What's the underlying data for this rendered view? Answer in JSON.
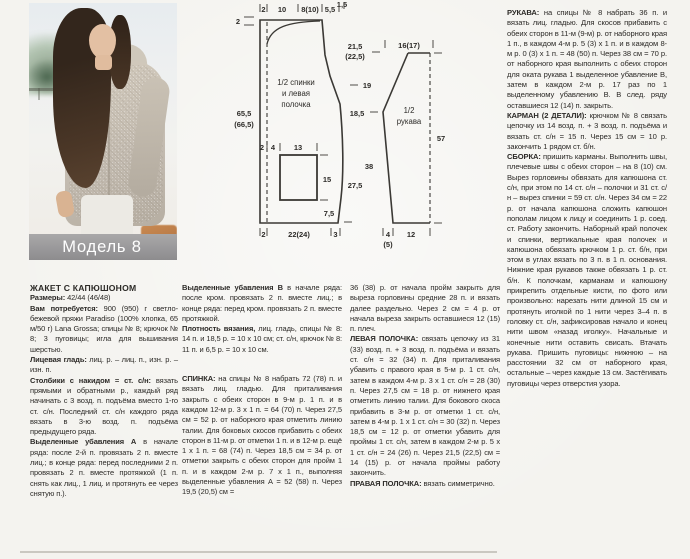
{
  "page": {
    "caption": "Модель 8"
  },
  "diagram": {
    "back": {
      "name_lines": [
        "1/2 спинки",
        "и левая",
        "полочка"
      ],
      "top_widths": [
        "2",
        "10",
        "8(10)",
        "5,5"
      ],
      "top_width_small": "1,5",
      "left_edge_top": "2",
      "height_total_1": "65,5",
      "height_total_2": "(66,5)",
      "pocket_left_1": "2",
      "pocket_left_2": "4",
      "pocket_width": "13",
      "pocket_height": "15",
      "pocket_to_hem": "7,5",
      "bottom_1": "2",
      "bottom_2": "22(24)",
      "bottom_3": "3"
    },
    "heights": {
      "h1a": "21,5",
      "h1b": "(22,5)",
      "h2": "19",
      "h3": "18,5",
      "h4": "27,5"
    },
    "sleeve": {
      "name_lines": [
        "1/2",
        "рукава"
      ],
      "top_width": "16(17)",
      "height": "57",
      "slant": "38",
      "bottom_1": "4",
      "bottom_1_alt": "(5)",
      "bottom_2": "12"
    }
  },
  "columns": {
    "col1": {
      "title": "ЖАКЕТ С КАПЮШОНОМ",
      "paras": [
        {
          "label": "Размеры:",
          "text": " 42/44 (46/48)"
        },
        {
          "label": "Вам потребуется:",
          "text": " 900 (950) г светло-бежевой пряжи Paradiso (100% хлопка, 65 м/50 г) Lana Grossa; спицы № 8; крючок № 8; 3 пуговицы; игла для вышивания шерстью."
        },
        {
          "label": "Лицевая гладь:",
          "text": " лиц. р. – лиц. п., изн. р. – изн. п."
        },
        {
          "label": "Столбики с накидом = ст. с/н:",
          "text": " вязать прямыми и обратными р., каждый ряд начинать с 3 возд. п. подъёма вместо 1-го ст. с/н. Последний ст. с/н каждого ряда вязать в 3-ю возд. п. подъёма предыдущего ряда."
        },
        {
          "label": "Выделенные убавления А",
          "text": " в начале ряда: после 2-й п. провязать 2 п. вместе лиц.; в конце ряда: перед последними 2 п. провязать 2 п. вместе протяжкой (1 п. снять как лиц., 1 лиц. и протянуть ее через снятую п.)."
        }
      ]
    },
    "col2": {
      "paras": [
        {
          "label": "Выделенные убавления В",
          "text": " в начале ряда: после кром. провязать 2 п. вместе лиц.; в конце ряда: перед кром. провязать 2 п. вместе протяжкой."
        },
        {
          "label": "Плотность вязания,",
          "text": " лиц. гладь, спицы № 8: 14 п. и 18,5 р. = 10 х 10 см; ст. с/н, крючок № 8: 11 п. и 6,5 р. = 10 х 10 см."
        },
        {
          "label": "СПИНКА:",
          "text": " на спицы № 8 набрать 72 (78) п. и вязать лиц. гладью. Для приталивания закрыть с обеих сторон в 9-м р. 1 п. и в каждом 12-м р. 3 х 1 п. = 64 (70) п. Через 27,5 см = 52 р. от наборного края отметить линию талии. Для боковых скосов прибавить с обеих сторон в 11-м р. от отметки 1 п. и в 12-м р. ещё 1 х 1 п. = 68 (74) п. Через 18,5 см = 34 р. от отметки закрыть с обеих сторон для пройм 1 п. и в каждом 2-м р. 7 х 1 п., выполняя выделенные убавления А = 52 (58) п. Через 19,5 (20,5) см ="
        }
      ]
    },
    "col3": {
      "paras": [
        {
          "label": "",
          "text": "36 (38) р. от начала пройм закрыть для выреза горловины средние 28 п. и вязать далее раздельно. Через 2 см = 4 р. от начала выреза закрыть оставшиеся 12 (15) п. плеч."
        },
        {
          "label": "ЛЕВАЯ ПОЛОЧКА:",
          "text": " связать цепочку из 31 (33) возд. п. + 3 возд. п. подъёма и вязать ст. с/н = 32 (34) п. Для приталивания убавить с правого края в 5-м р. 1 ст. с/н, затем в каждом 4-м р. 3 х 1 ст. с/н = 28 (30) п. Через 27,5 см = 18 р. от нижнего края отметить линию талии. Для бокового скоса прибавить в 3-м р. от отметки 1 ст. с/н, затем в 4-м р. 1 х 1 ст. с/н = 30 (32) п. Через 18,5 см = 12 р. от отметки убавить для проймы 1 ст. с/н, затем в каждом 2-м р. 5 х 1 ст. с/н = 24 (26) п. Через 21,5 (22,5) см = 14 (15) р. от начала проймы работу закончить."
        },
        {
          "label": "ПРАВАЯ ПОЛОЧКА:",
          "text": " вязать симметрично."
        }
      ]
    },
    "col4": {
      "paras": [
        {
          "label": "РУКАВА:",
          "text": " на спицы № 8 набрать 36 п. и вязать лиц. гладью. Для скосов прибавить с обеих сторон в 11-м (9-м) р. от наборного края 1 п., в каждом 4-м р. 5 (3) х 1 п. и в каждом 8-м р. 0 (3) х 1 п. = 48 (50) п. Через 38 см = 70 р. от наборного края выполнить с обеих сторон для оката рукава 1 выделенное убавление В, затем в каждом 2-м р. 17 раз по 1 выделенному убавлению В. В след. ряду оставшиеся 12 (14) п. закрыть."
        },
        {
          "label": "КАРМАН (2 ДЕТАЛИ):",
          "text": " крючком № 8 связать цепочку из 14 возд. п. + 3 возд. п. подъёма и вязать ст. с/н = 15 п. Через 15 см = 10 р. закончить 1 рядом ст. б/н."
        },
        {
          "label": "СБОРКА:",
          "text": " пришить карманы. Выполнить швы, плечевые швы с обеих сторон – на 8 (10) см. Вырез горловины обвязать для капюшона ст. с/н, при этом по 14 ст. с/н – полочки и 31 ст. с/н – вырез спинки = 59 ст. с/н. Через 34 см = 22 р. от начала капюшона сложить капюшон пополам лицом к лицу и соединить 1 р. соед. ст. Работу закончить. Наборный край полочек и спинки, вертикальные края полочек и капюшона обвязать крючком 1 р. ст. б/н, при этом в углах вязать по 3 п. в 1 п. основания. Нижние края рукавов также обвязать 1 р. ст. б/н. К полочкам, карманам и капюшону прикрепить отдельные кисти, по фото или произвольно: нарезать нити длиной 15 см и протянуть иголкой по 1 нити через 3–4 п. в головку ст. с/н, зафиксировав начало и конец нити швом «назад иголку». Начальные и конечные нити оставить свисать. Втачать рукава. Пришить пуговицы: нижнюю – на расстоянии 32 см от наборного края, остальные – через каждые 13 см. Застёгивать пуговицы через отверстия узора."
        }
      ]
    }
  }
}
